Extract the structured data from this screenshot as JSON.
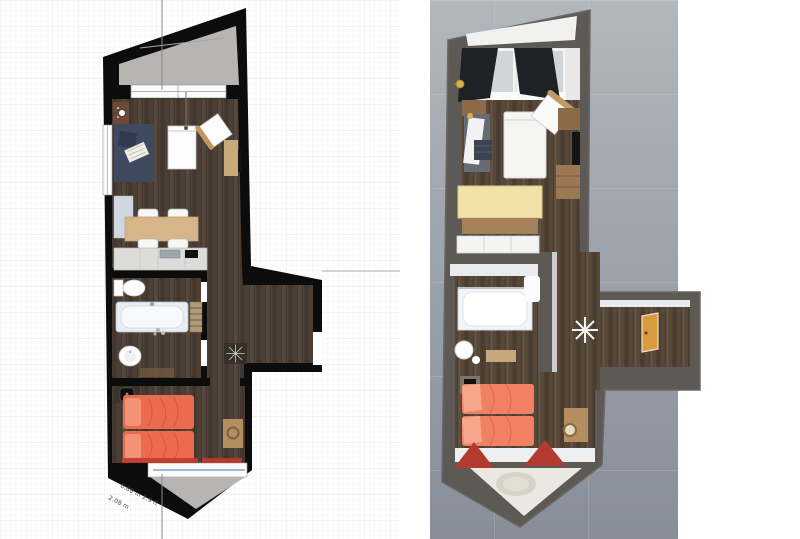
{
  "panels": {
    "left_name": "2d-floor-plan",
    "right_name": "3d-floor-plan"
  },
  "dimension_labels": {
    "slope_dim_1": "0.88 m 2.9 ft",
    "slope_dim_2": "2.08 m"
  },
  "colors": {
    "plan2d_wall": "#0c0c0c",
    "plan2d_wood": "#4c4036",
    "plan2d_concrete": "#b7b5b1",
    "plan2d_rug_navy": "#3f4a61",
    "plan2d_bed_orange": "#ec6a4e",
    "plan2d_pillow_orange": "#f29277",
    "plan2d_curtain_red": "#c23a2c",
    "plan2d_window_glass": "#7fa8cc",
    "plan2d_table_tan": "#d7b58a",
    "plan2d_desk_tan": "#c9a87a",
    "plan3d_ground": "#9aa0a8",
    "plan3d_wall": "#5d5955",
    "plan3d_wood": "#564739",
    "plan3d_table_cream": "#f1e1a7",
    "plan3d_table_base": "#a5815a",
    "plan3d_bed_orange": "#f08263",
    "plan3d_pillow": "#f5a68c",
    "plan3d_curtain_dark": "#1e2126",
    "plan3d_curtain_red": "#b23a2f",
    "plan3d_door_gold": "#d79a3d",
    "plan3d_balcony_floor": "#ebe8e2"
  }
}
